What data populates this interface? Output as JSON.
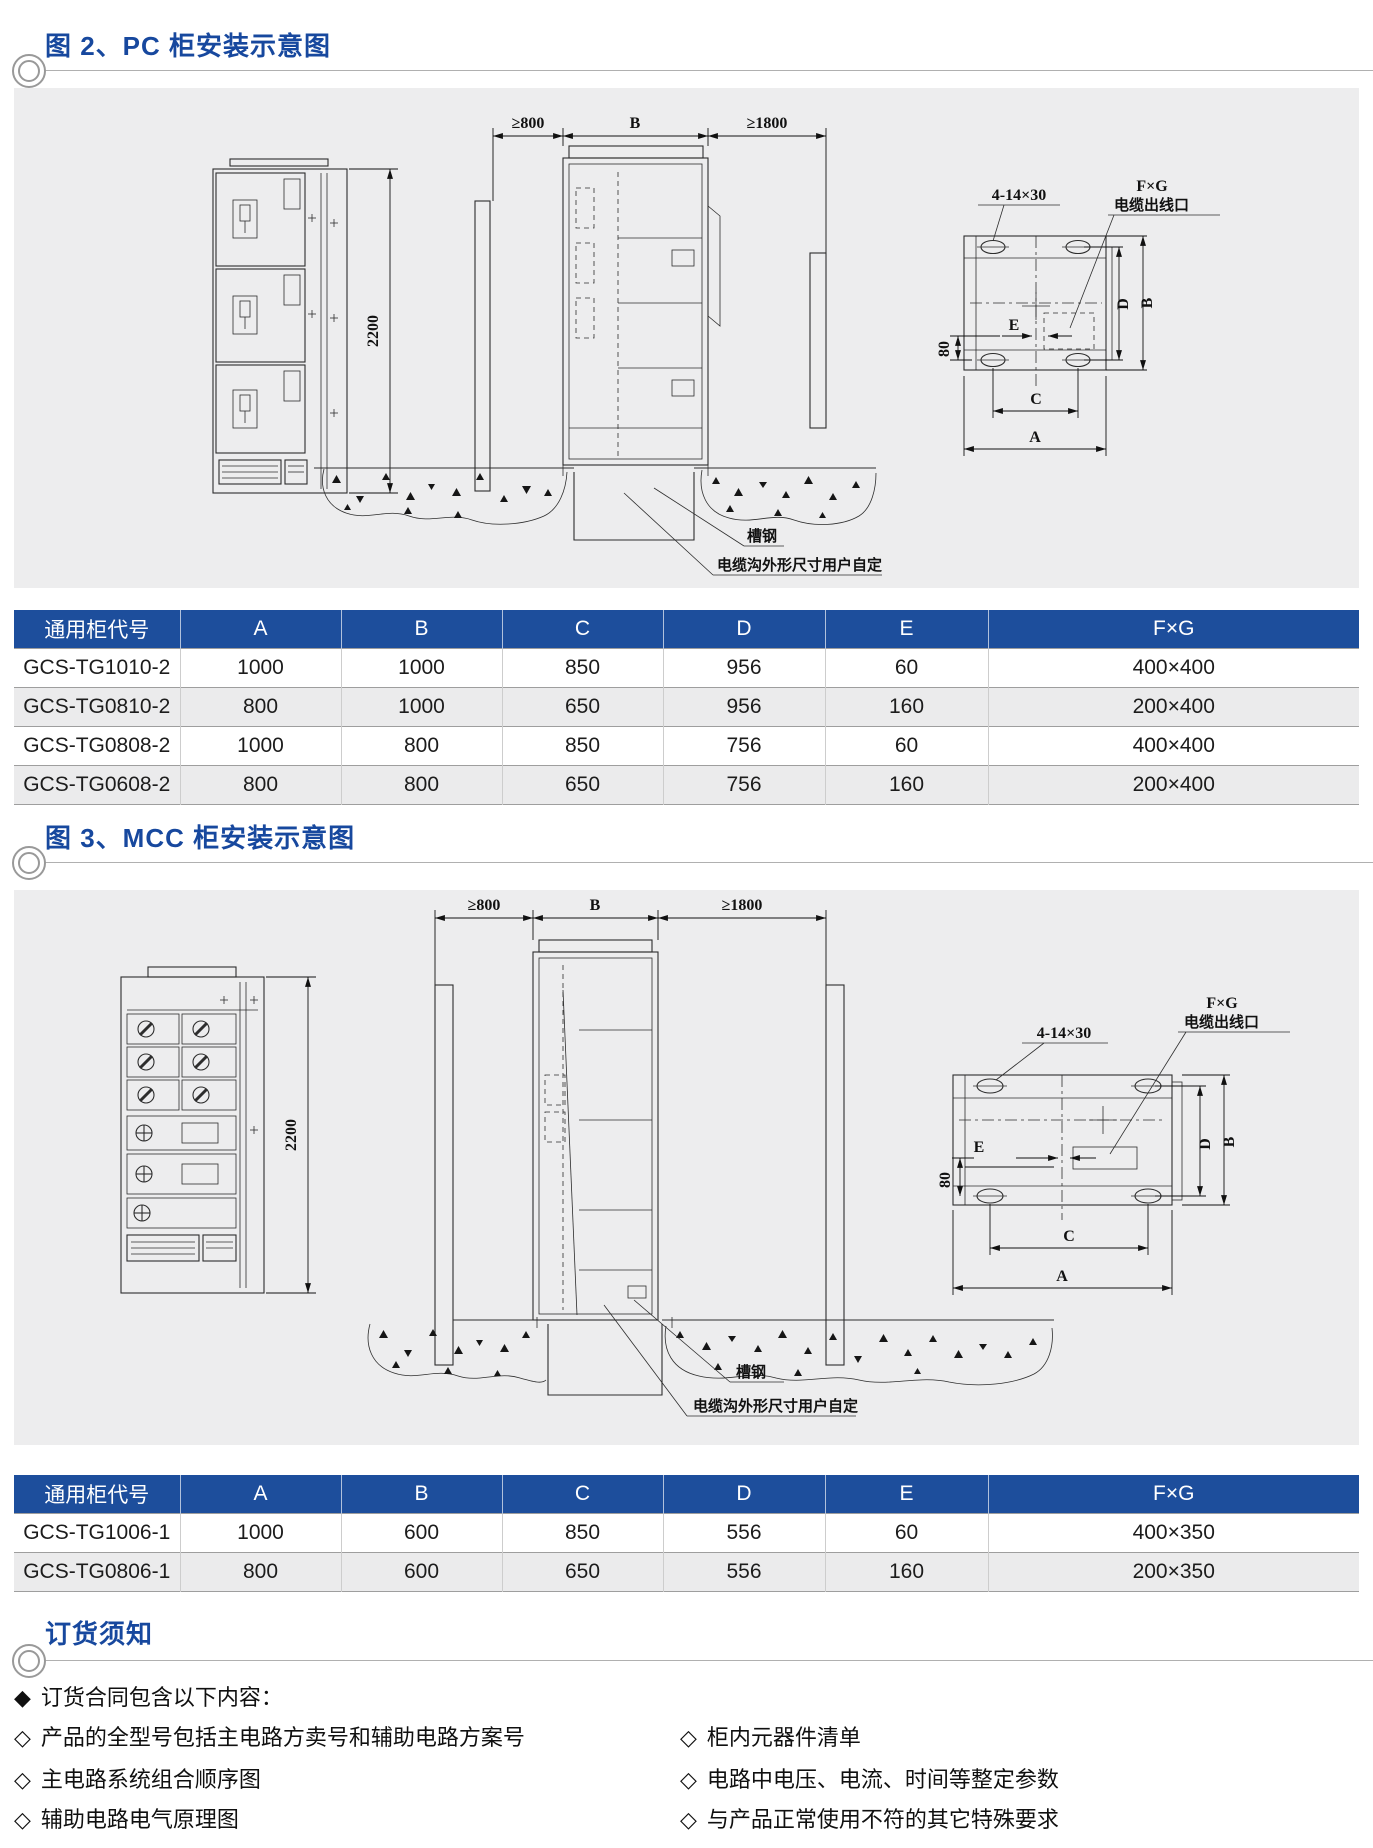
{
  "figure2": {
    "title": "图 2、PC 柜安装示意图",
    "drawing": {
      "clearance_left": "≥800",
      "width_b": "B",
      "clearance_right": "≥1800",
      "height": "2200",
      "bolt_hole": "4-14×30",
      "fg": "F×G",
      "cable_outlet": "电缆出线口",
      "e": "E",
      "eighty": "80",
      "d": "D",
      "b": "B",
      "c": "C",
      "a": "A",
      "channel_steel": "槽钢",
      "cable_trench": "电缆沟外形尺寸用户自定"
    }
  },
  "table1": {
    "headers": [
      "通用柜代号",
      "A",
      "B",
      "C",
      "D",
      "E",
      "F×G"
    ],
    "rows": [
      [
        "GCS-TG1010-2",
        "1000",
        "1000",
        "850",
        "956",
        "60",
        "400×400"
      ],
      [
        "GCS-TG0810-2",
        "800",
        "1000",
        "650",
        "956",
        "160",
        "200×400"
      ],
      [
        "GCS-TG0808-2",
        "1000",
        "800",
        "850",
        "756",
        "60",
        "400×400"
      ],
      [
        "GCS-TG0608-2",
        "800",
        "800",
        "650",
        "756",
        "160",
        "200×400"
      ]
    ]
  },
  "figure3": {
    "title": "图 3、MCC 柜安装示意图",
    "drawing": {
      "clearance_left": "≥800",
      "width_b": "B",
      "clearance_right": "≥1800",
      "height": "2200",
      "bolt_hole": "4-14×30",
      "fg": "F×G",
      "cable_outlet": "电缆出线口",
      "e": "E",
      "eighty": "80",
      "d": "D",
      "b": "B",
      "c": "C",
      "a": "A",
      "channel_steel": "槽钢",
      "cable_trench": "电缆沟外形尺寸用户自定"
    }
  },
  "table2": {
    "headers": [
      "通用柜代号",
      "A",
      "B",
      "C",
      "D",
      "E",
      "F×G"
    ],
    "rows": [
      [
        "GCS-TG1006-1",
        "1000",
        "600",
        "850",
        "556",
        "60",
        "400×350"
      ],
      [
        "GCS-TG0806-1",
        "800",
        "600",
        "650",
        "556",
        "160",
        "200×350"
      ]
    ]
  },
  "ordering": {
    "title": "订货须知",
    "heading_bullet": "◆",
    "heading": "订货合同包含以下内容：",
    "item_bullet": "◇",
    "left_items": [
      "产品的全型号包括主电路方卖号和辅助电路方案号",
      "主电路系统组合顺序图",
      "辅助电路电气原理图"
    ],
    "right_items": [
      "柜内元器件清单",
      "电路中电压、电流、时间等整定参数",
      "与产品正常使用不符的其它特殊要求"
    ]
  },
  "colors": {
    "title_blue": "#17489e",
    "table_header_blue": "#1d4e9c",
    "panel_gray": "#ededee"
  }
}
